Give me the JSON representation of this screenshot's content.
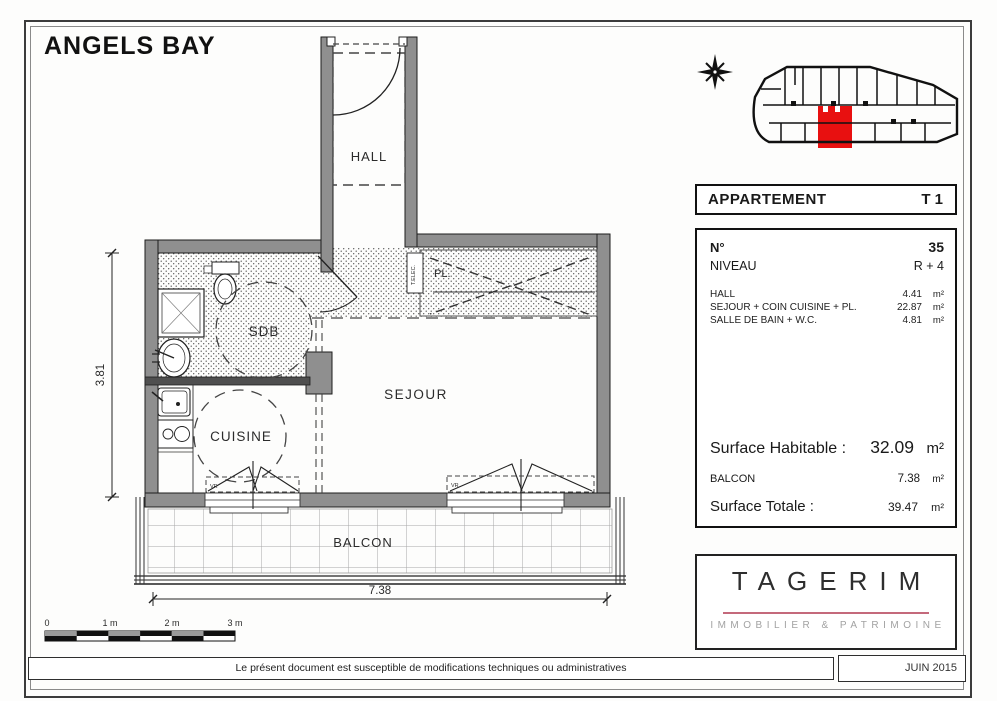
{
  "page": {
    "title": "ANGELS BAY",
    "footer_note": "Le présent document est susceptible de modifications techniques ou administratives",
    "date": "JUIN 2015"
  },
  "apartment_header": {
    "label": "APPARTEMENT",
    "type": "T 1"
  },
  "info": {
    "number_label": "N°",
    "number_value": "35",
    "level_label": "NIVEAU",
    "level_value": "R + 4",
    "rooms": [
      {
        "label": "HALL",
        "value": "4.41",
        "unit": "m²"
      },
      {
        "label": "SEJOUR + COIN CUISINE + PL.",
        "value": "22.87",
        "unit": "m²"
      },
      {
        "label": "SALLE DE BAIN + W.C.",
        "value": "4.81",
        "unit": "m²"
      }
    ],
    "surface_habitable": {
      "label": "Surface Habitable :",
      "value": "32.09",
      "unit": "m²"
    },
    "balcon": {
      "label": "BALCON",
      "value": "7.38",
      "unit": "m²"
    },
    "surface_totale": {
      "label": "Surface Totale :",
      "value": "39.47",
      "unit": "m²"
    }
  },
  "plan": {
    "labels": {
      "hall": "HALL",
      "sdb": "SDB",
      "cuisine": "CUISINE",
      "sejour": "SEJOUR",
      "balcon": "BALCON",
      "placard": "PL.",
      "tableau_electrique": "T.ELEC.",
      "vr": "VR"
    },
    "dimensions": {
      "width_m": "7.38",
      "height_m": "3.81"
    },
    "scale_bar": {
      "ticks": [
        "0",
        "1 m",
        "2 m",
        "3 m"
      ]
    }
  },
  "logo": {
    "name": "TAGERIM",
    "tagline": "IMMOBILIER & PATRIMOINE"
  },
  "colors": {
    "wall_gray": "#8f8f8f",
    "highlight_red": "#e81010",
    "logo_line_pink": "#c4697b",
    "logo_tagline_gray": "#a2a2a2"
  }
}
